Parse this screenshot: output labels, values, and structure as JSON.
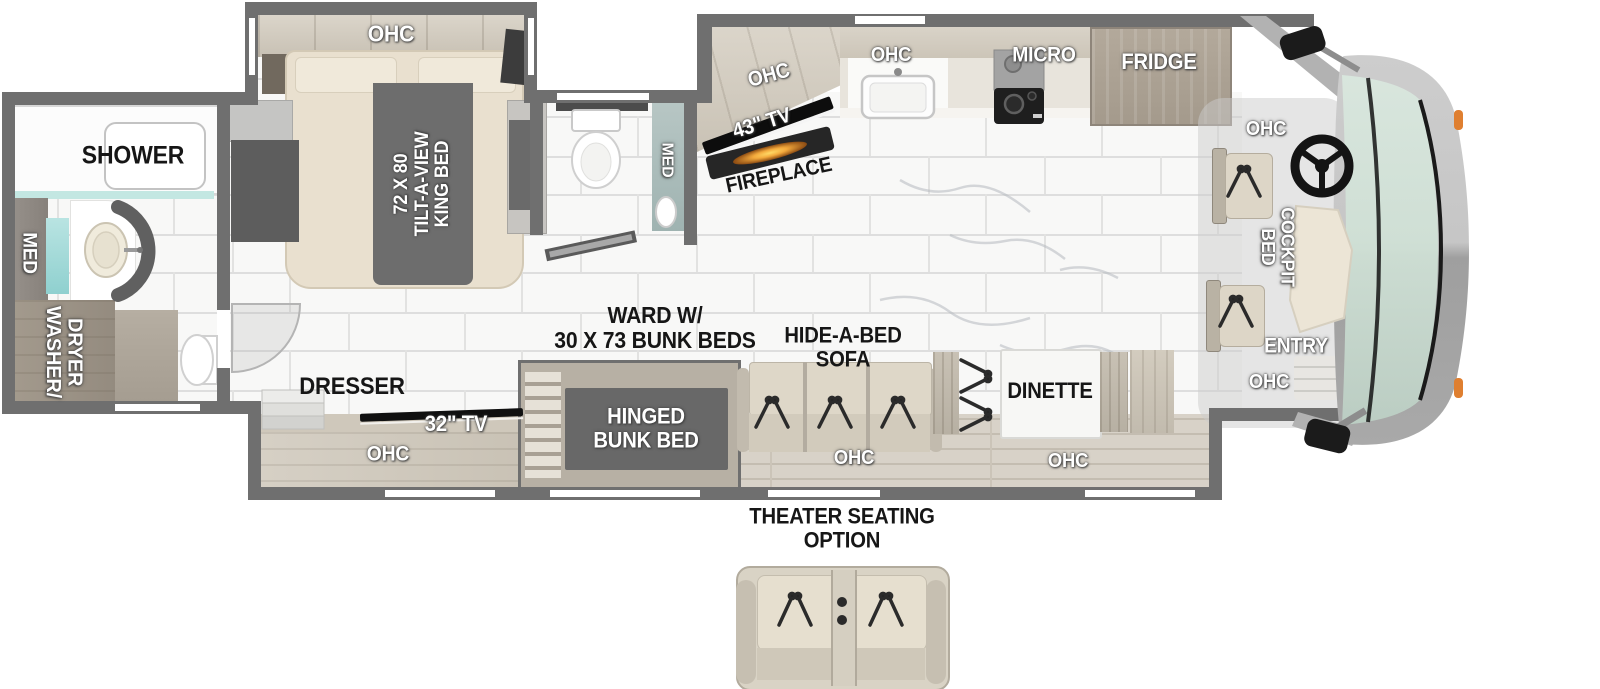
{
  "floorplan": {
    "rear_bath": {
      "shower": "SHOWER",
      "med_cabinet": "MED",
      "washer_dryer": "WASHER/\nDRYER"
    },
    "bedroom": {
      "ohc": "OHC",
      "king_bed": "72 X 80\nTILT-A-VIEW\nKING BED",
      "dresser": "DRESSER",
      "tv": "32\" TV",
      "ohc_dresser": "OHC"
    },
    "mid_bath": {
      "med_cabinet": "MED"
    },
    "living": {
      "tv": "43\" TV",
      "fireplace": "FIREPLACE",
      "ohc_tv": "OHC",
      "ward_bunks": "WARD W/\n30 X 73 BUNK BEDS",
      "hinged_bunk_bed": "HINGED\nBUNK BED",
      "hide_a_bed_sofa": "HIDE-A-BED\nSOFA",
      "ohc_sofa": "OHC",
      "dinette": "DINETTE",
      "ohc_dinette": "OHC"
    },
    "kitchen": {
      "ohc_sink": "OHC",
      "micro": "MICRO",
      "fridge": "FRIDGE"
    },
    "cockpit": {
      "ohc_top": "OHC",
      "cockpit_bed": "COCKPIT\nBED",
      "entry": "ENTRY",
      "ohc_bottom": "OHC"
    },
    "options": {
      "theater_seating": "THEATER SEATING\nOPTION"
    }
  },
  "colors": {
    "wall": "#6f6f6f",
    "wood_light": "#d7d1c6",
    "wood_dark": "#a99f93",
    "bed_cream": "#e9e0cf",
    "glass_teal": "#cfe0d6",
    "mirror_teal": "#9fd4d2",
    "fireplace_glow": "#f3a93c",
    "marker_orange": "#df7f30"
  }
}
